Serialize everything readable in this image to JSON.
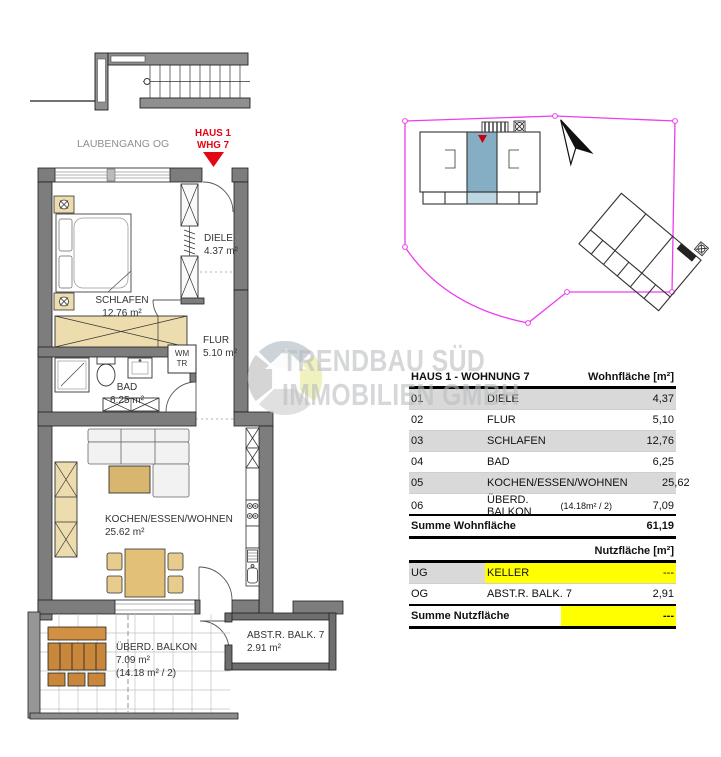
{
  "plan": {
    "corridor_label": "LAUBENGANG OG",
    "marker": {
      "line1": "HAUS 1",
      "line2": "WHG 7"
    },
    "rooms": {
      "diele": {
        "name": "DIELE",
        "area": "4.37 m²"
      },
      "flur": {
        "name": "FLUR",
        "area": "5.10 m²"
      },
      "schlafen": {
        "name": "SCHLAFEN",
        "area": "12.76 m²"
      },
      "bad": {
        "name": "BAD",
        "area": "6.25 m²"
      },
      "wohnen": {
        "name": "KOCHEN/ESSEN/WOHNEN",
        "area": "25.62 m²"
      },
      "balkon": {
        "name": "ÜBERD. BALKON",
        "area": "7.09 m²",
        "note": "(14.18 m² / 2)"
      },
      "abstellraum": {
        "name": "ABST.R. BALK. 7",
        "area": "2.91 m²"
      },
      "technik": {
        "line1": "WM",
        "line2": "TR"
      }
    }
  },
  "watermark": {
    "line1": "TRENDBAU SÜD",
    "line2": "IMMOBILIEN GMBH"
  },
  "tables": {
    "wohnflaeche": {
      "title": "HAUS 1 - WOHNUNG 7",
      "unit_header": "Wohnfläche [m²]",
      "rows": [
        {
          "nr": "01",
          "name": "DIELE",
          "note": "",
          "value": "4,37"
        },
        {
          "nr": "02",
          "name": "FLUR",
          "note": "",
          "value": "5,10"
        },
        {
          "nr": "03",
          "name": "SCHLAFEN",
          "note": "",
          "value": "12,76"
        },
        {
          "nr": "04",
          "name": "BAD",
          "note": "",
          "value": "6,25"
        },
        {
          "nr": "05",
          "name": "KOCHEN/ESSEN/WOHNEN",
          "note": "",
          "value": "25,62"
        },
        {
          "nr": "06",
          "name": "ÜBERD. BALKON",
          "note": "(14.18m² / 2)",
          "value": "7,09"
        }
      ],
      "sum_label": "Summe Wohnfläche",
      "sum_value": "61,19"
    },
    "nutzflaeche": {
      "unit_header": "Nutzfläche [m²]",
      "rows": [
        {
          "nr": "UG",
          "name": "KELLER",
          "value": "---"
        },
        {
          "nr": "OG",
          "name": "ABST.R. BALK. 7",
          "value": "2,91"
        }
      ],
      "sum_label": "Summe Nutzfläche",
      "sum_value": "---"
    }
  },
  "colors": {
    "marker_red": "#e30613",
    "wall_gray": "#7d7d7d",
    "row_gray": "#d9d9d9",
    "highlight_yellow": "#ffff00",
    "boundary_magenta": "#ee3cee",
    "unit_highlight_blue": "#85aec5",
    "wood_tan": "#ecdcae",
    "balcony_wood": "#c9873b"
  }
}
